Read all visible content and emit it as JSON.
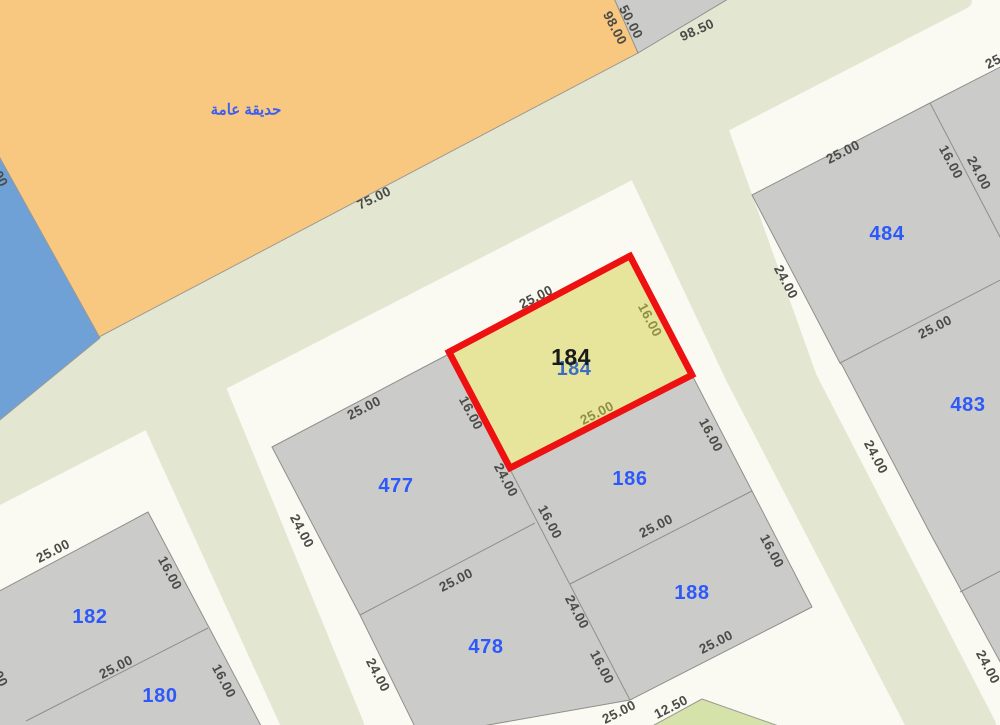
{
  "map": {
    "colors": {
      "road": "#faf9f2",
      "median_green": "#e3e7d2",
      "park_orange": "#f9c880",
      "water_blue": "#6fa0d6",
      "parcel_gray": "#cbcbca",
      "parcel_edge": "#8f8f8c",
      "selected_fill": "#e7e59b",
      "selected_border": "#ee1111",
      "garden_green": "#d5e2a9",
      "dim_text": "#4b4b47",
      "dim_text_olive": "#8d8f45",
      "parcel_number_blue": "#2e59f9",
      "selected_number_black": "#1a1a1a",
      "selected_number_echo": "#3d6fc0",
      "park_label_blue": "#3d5ff0"
    },
    "areas": [
      {
        "name": "road-median-main",
        "pts": [
          [
            -10,
            386
          ],
          [
            741,
            0
          ],
          [
            963,
            0
          ],
          [
            -10,
            500
          ]
        ],
        "fill": "#e3e7d2",
        "stroke": "#e3e7d2",
        "sw": 18,
        "interactable": false
      },
      {
        "name": "road-median-elbow",
        "pts": [
          [
            636,
            168
          ],
          [
            718,
            126
          ],
          [
            808,
            378
          ],
          [
            735,
            378
          ]
        ],
        "fill": "#e3e7d2",
        "stroke": "#e3e7d2",
        "sw": 18,
        "interactable": false
      },
      {
        "name": "road-median-right",
        "pts": [
          [
            735,
            378
          ],
          [
            808,
            378
          ],
          [
            987,
            725
          ],
          [
            915,
            725
          ]
        ],
        "fill": "#e3e7d2",
        "stroke": "#e3e7d2",
        "sw": 18,
        "interactable": false
      },
      {
        "name": "road-median-left",
        "pts": [
          [
            150,
            418
          ],
          [
            215,
            384
          ],
          [
            355,
            725
          ],
          [
            290,
            725
          ]
        ],
        "fill": "#e3e7d2",
        "stroke": "#e3e7d2",
        "sw": 18,
        "interactable": false
      },
      {
        "name": "public-garden-area",
        "pts": [
          [
            -10,
            -10
          ],
          [
            615,
            -10
          ],
          [
            638,
            53
          ],
          [
            97,
            338
          ],
          [
            -10,
            148
          ]
        ],
        "fill": "#f9c880",
        "stroke": "#9a9a94",
        "sw": 1,
        "interactable": true
      },
      {
        "name": "water-area",
        "pts": [
          [
            -10,
            140
          ],
          [
            100,
            338
          ],
          [
            -10,
            428
          ]
        ],
        "fill": "#6fa0d6",
        "stroke": "#9a9a94",
        "sw": 1,
        "interactable": true
      },
      {
        "name": "triangle-parcel-block",
        "pts": [
          [
            613,
            -4
          ],
          [
            733,
            -4
          ],
          [
            638,
            53
          ]
        ],
        "fill": "#cbcbca",
        "stroke": "#8f8f8c",
        "sw": 1,
        "interactable": true
      },
      {
        "name": "center-parcel-block",
        "pts": [
          [
            272,
            447
          ],
          [
            447,
            355
          ],
          [
            449,
            352
          ],
          [
            630,
            256
          ],
          [
            692,
            375
          ],
          [
            752,
            491
          ],
          [
            812,
            607
          ],
          [
            630,
            700
          ],
          [
            420,
            737
          ],
          [
            360,
            615
          ]
        ],
        "fill": "#cbcbca",
        "stroke": "#8f8f8c",
        "sw": 1,
        "interactable": true
      },
      {
        "name": "southwest-parcel-block",
        "pts": [
          [
            -10,
            596
          ],
          [
            148,
            512
          ],
          [
            278,
            758
          ],
          [
            -10,
            758
          ]
        ],
        "fill": "#cbcbca",
        "stroke": "#8f8f8c",
        "sw": 1,
        "interactable": true
      },
      {
        "name": "east-parcel-block",
        "pts": [
          [
            752,
            195
          ],
          [
            930,
            103
          ],
          [
            1010,
            62
          ],
          [
            1010,
            680
          ],
          [
            930,
            533
          ],
          [
            842,
            365
          ],
          [
            840,
            363
          ]
        ],
        "fill": "#cbcbca",
        "stroke": "#8f8f8c",
        "sw": 1,
        "interactable": true
      },
      {
        "name": "garden-parcel-south",
        "pts": [
          [
            702,
            699
          ],
          [
            645,
            730
          ],
          [
            790,
            730
          ]
        ],
        "fill": "#d5e2a9",
        "stroke": "#9a9a94",
        "sw": 1,
        "interactable": true
      },
      {
        "name": "selected-parcel-184",
        "pts": [
          [
            449,
            352
          ],
          [
            630,
            256
          ],
          [
            692,
            375
          ],
          [
            510,
            468
          ]
        ],
        "fill": "#e7e59b",
        "stroke": "#ee1111",
        "sw": 6.5,
        "interactable": true
      }
    ],
    "boundary_lines": [
      {
        "name": "lot-line",
        "x1": 449,
        "y1": 352,
        "x2": 630,
        "y2": 700
      },
      {
        "name": "lot-line",
        "x1": 360,
        "y1": 615,
        "x2": 535,
        "y2": 523
      },
      {
        "name": "lot-line",
        "x1": 570,
        "y1": 584,
        "x2": 752,
        "y2": 491
      },
      {
        "name": "lot-line",
        "x1": 26,
        "y1": 721,
        "x2": 208,
        "y2": 628
      },
      {
        "name": "lot-line",
        "x1": 840,
        "y1": 363,
        "x2": 1010,
        "y2": 275
      },
      {
        "name": "lot-line",
        "x1": 930,
        "y1": 103,
        "x2": 1010,
        "y2": 256
      },
      {
        "name": "lot-line",
        "x1": 960,
        "y1": 592,
        "x2": 1010,
        "y2": 566
      }
    ],
    "dimension_labels": [
      {
        "t": "98.00",
        "x": 615,
        "y": 28,
        "r": 62
      },
      {
        "t": "50.00",
        "x": 631,
        "y": 22,
        "r": 62
      },
      {
        "t": "98.50",
        "x": 697,
        "y": 30,
        "r": -24
      },
      {
        "t": "75.00",
        "x": 374,
        "y": 198,
        "r": -26
      },
      {
        "t": "25.00",
        "x": 536,
        "y": 297,
        "r": -27
      },
      {
        "t": "16.00",
        "x": 650,
        "y": 320,
        "r": 62,
        "olive": true
      },
      {
        "t": "25.00",
        "x": 597,
        "y": 413,
        "r": -27,
        "olive": true
      },
      {
        "t": "16.00",
        "x": 471,
        "y": 413,
        "r": 62
      },
      {
        "t": "24.00",
        "x": 506,
        "y": 480,
        "r": 62
      },
      {
        "t": "16.00",
        "x": 550,
        "y": 522,
        "r": 62
      },
      {
        "t": "25.00",
        "x": 364,
        "y": 408,
        "r": -27
      },
      {
        "t": "24.00",
        "x": 302,
        "y": 531,
        "r": 62
      },
      {
        "t": "25.00",
        "x": 456,
        "y": 580,
        "r": -27
      },
      {
        "t": "24.00",
        "x": 378,
        "y": 675,
        "r": 62
      },
      {
        "t": "24.00",
        "x": 577,
        "y": 612,
        "r": 62
      },
      {
        "t": "16.00",
        "x": 602,
        "y": 667,
        "r": 62
      },
      {
        "t": "25.00",
        "x": 619,
        "y": 712,
        "r": -27
      },
      {
        "t": "12.50",
        "x": 671,
        "y": 707,
        "r": -27
      },
      {
        "t": "25.00",
        "x": 656,
        "y": 526,
        "r": -27
      },
      {
        "t": "16.00",
        "x": 711,
        "y": 435,
        "r": 62
      },
      {
        "t": "16.00",
        "x": 772,
        "y": 551,
        "r": 62
      },
      {
        "t": "25.00",
        "x": 716,
        "y": 642,
        "r": -27
      },
      {
        "t": "25.00",
        "x": 53,
        "y": 551,
        "r": -27
      },
      {
        "t": "16.00",
        "x": 170,
        "y": 573,
        "r": 62
      },
      {
        "t": "25.00",
        "x": 116,
        "y": 667,
        "r": -27
      },
      {
        "t": "16.00",
        "x": 224,
        "y": 681,
        "r": 62
      },
      {
        "t": "25.00",
        "x": 843,
        "y": 152,
        "r": -27
      },
      {
        "t": "16.00",
        "x": 951,
        "y": 162,
        "r": 62
      },
      {
        "t": "24.00",
        "x": 979,
        "y": 173,
        "r": 62
      },
      {
        "t": "24.00",
        "x": 786,
        "y": 282,
        "r": 62
      },
      {
        "t": "25.00",
        "x": 935,
        "y": 327,
        "r": -27
      },
      {
        "t": "24.00",
        "x": 876,
        "y": 457,
        "r": 62
      },
      {
        "t": "24.00",
        "x": 988,
        "y": 667,
        "r": 62
      },
      {
        "t": "25.00",
        "x": 1002,
        "y": 57,
        "r": -27
      },
      {
        "t": "50.00",
        "x": -4,
        "y": 170,
        "r": 62
      },
      {
        "t": "16.00",
        "x": -4,
        "y": 670,
        "r": 62
      }
    ],
    "parcel_labels": [
      {
        "t": "477",
        "x": 396,
        "y": 486
      },
      {
        "t": "478",
        "x": 486,
        "y": 647
      },
      {
        "t": "186",
        "x": 630,
        "y": 479
      },
      {
        "t": "188",
        "x": 692,
        "y": 593
      },
      {
        "t": "182",
        "x": 90,
        "y": 617
      },
      {
        "t": "180",
        "x": 160,
        "y": 696
      },
      {
        "t": "484",
        "x": 887,
        "y": 234
      },
      {
        "t": "483",
        "x": 968,
        "y": 405
      }
    ],
    "selected_parcel": {
      "number": "184",
      "label_x": 571,
      "label_y": 357,
      "echo_x": 574,
      "echo_y": 369
    },
    "park_label": {
      "text": "حديقة عامة",
      "x": 246,
      "y": 110
    }
  }
}
